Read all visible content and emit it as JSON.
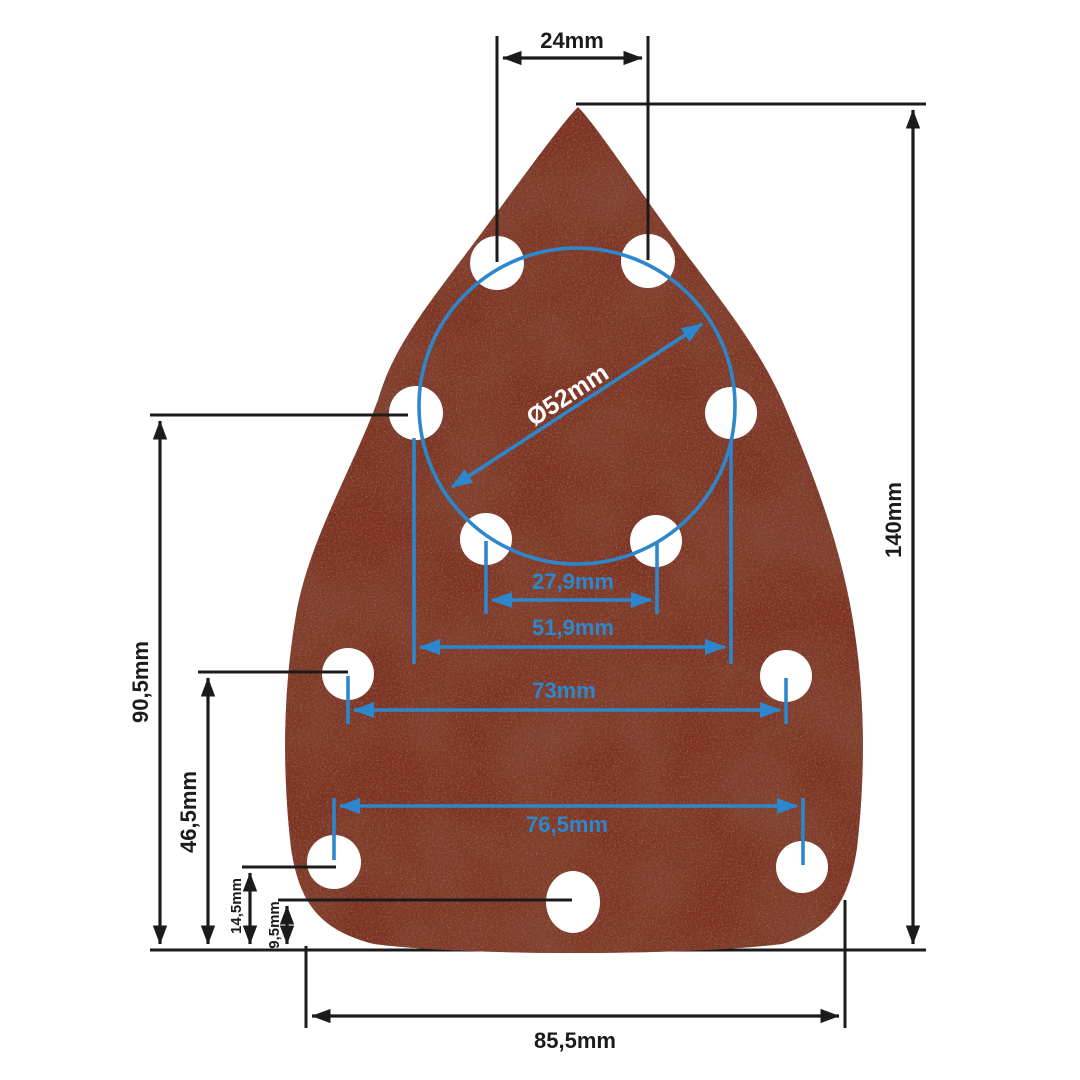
{
  "figure": {
    "kind": "technical-dimension-diagram",
    "subject": "triangular-mouse-sander-sanding-sheet",
    "unit": "mm",
    "hole_count": 11
  },
  "colors": {
    "background": "#ffffff",
    "dimension_black": "#1b1b1b",
    "dimension_blue": "#2d87cc",
    "sheet_base": "#7c3122",
    "sheet_dark_grain": "#4a1a10",
    "sheet_light_grain": "#c98f72",
    "hole": "#ffffff"
  },
  "dims": {
    "top_holes_cc": {
      "label": "24mm",
      "value_mm": 24,
      "color": "black",
      "orientation": "horizontal"
    },
    "pad_height": {
      "label": "140mm",
      "value_mm": 140,
      "color": "black",
      "orientation": "vertical"
    },
    "circle_dia": {
      "label": "Ø52mm",
      "value_mm": 52,
      "color": "blue",
      "orientation": "diagonal"
    },
    "inner_cc": {
      "label": "27,9mm",
      "value_mm": 27.9,
      "color": "blue",
      "orientation": "horizontal"
    },
    "circle_holes_cc": {
      "label": "51,9mm",
      "value_mm": 51.9,
      "color": "blue",
      "orientation": "horizontal"
    },
    "mid_cc": {
      "label": "73mm",
      "value_mm": 73,
      "color": "blue",
      "orientation": "horizontal"
    },
    "lower_cc": {
      "label": "76,5mm",
      "value_mm": 76.5,
      "color": "blue",
      "orientation": "horizontal"
    },
    "side_holes_height": {
      "label": "90,5mm",
      "value_mm": 90.5,
      "color": "black",
      "orientation": "vertical"
    },
    "mid_holes_height": {
      "label": "46,5mm",
      "value_mm": 46.5,
      "color": "black",
      "orientation": "vertical"
    },
    "lower_holes_height": {
      "label": "14,5mm",
      "value_mm": 14.5,
      "color": "black",
      "orientation": "vertical"
    },
    "bottom_hole_height": {
      "label": "9,5mm",
      "value_mm": 9.5,
      "color": "black",
      "orientation": "vertical"
    },
    "pad_width": {
      "label": "85,5mm",
      "value_mm": 85.5,
      "color": "black",
      "orientation": "horizontal"
    }
  }
}
